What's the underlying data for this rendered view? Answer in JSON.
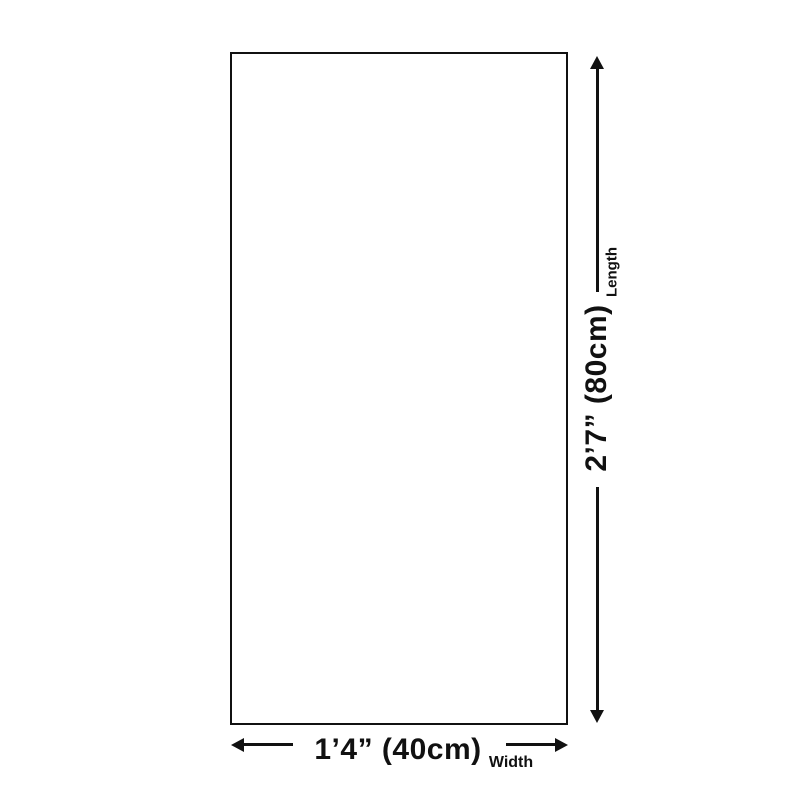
{
  "diagram": {
    "width": {
      "value": "1’4” (40cm)",
      "caption": "Width"
    },
    "length": {
      "value": "2’7” (80cm)",
      "caption": "Length"
    },
    "colors": {
      "line": "#111111",
      "background": "#ffffff"
    }
  }
}
